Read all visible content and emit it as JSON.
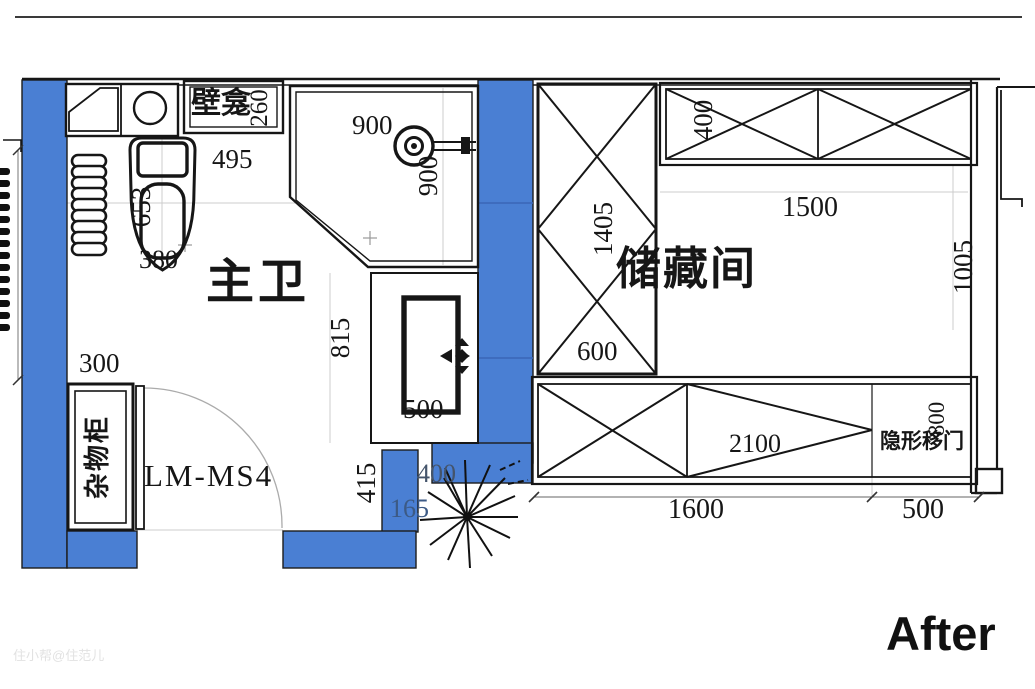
{
  "page": {
    "after_label": "After",
    "watermark": "住小帮@住范儿"
  },
  "bathroom": {
    "label": "主卫",
    "door_model": "LM-MS4",
    "niche_label": "壁龛",
    "cabinet_label": "杂物柜",
    "dims": {
      "niche_depth": "260",
      "counter_width": "495",
      "toilet_length": "653",
      "toilet_width": "380",
      "shower_width": "900",
      "shower_depth": "900",
      "washer_height": "815",
      "washer_width": "500",
      "cabinet_width": "300",
      "door_side": "415",
      "wall_step_a": "400",
      "wall_step_b": "165"
    }
  },
  "storage": {
    "label": "储藏间",
    "sliding_door_label": "隐形移门",
    "dims": {
      "tall_cabinet_height": "1405",
      "tall_cabinet_width": "600",
      "top_cabinet_depth": "400",
      "room_width": "1500",
      "room_depth": "1005",
      "bottom_cabinet_width": "2100",
      "sliding_door_width": "800",
      "bottom_left": "1600",
      "bottom_right": "500"
    }
  },
  "colors": {
    "wall_blue": "#4a7fd3",
    "ink": "#161616",
    "dim_on_wall_a": "#44546b",
    "dim_on_wall_b": "#3c5a85",
    "watermark_gray": "#e2e2e2"
  },
  "icons": {
    "shower_head": "shower-head-icon",
    "plant": "plant-icon",
    "washer_arrows": "cross-arrows-icon",
    "sink": "sink-circle-icon",
    "radiator": "towel-radiator-icon"
  }
}
